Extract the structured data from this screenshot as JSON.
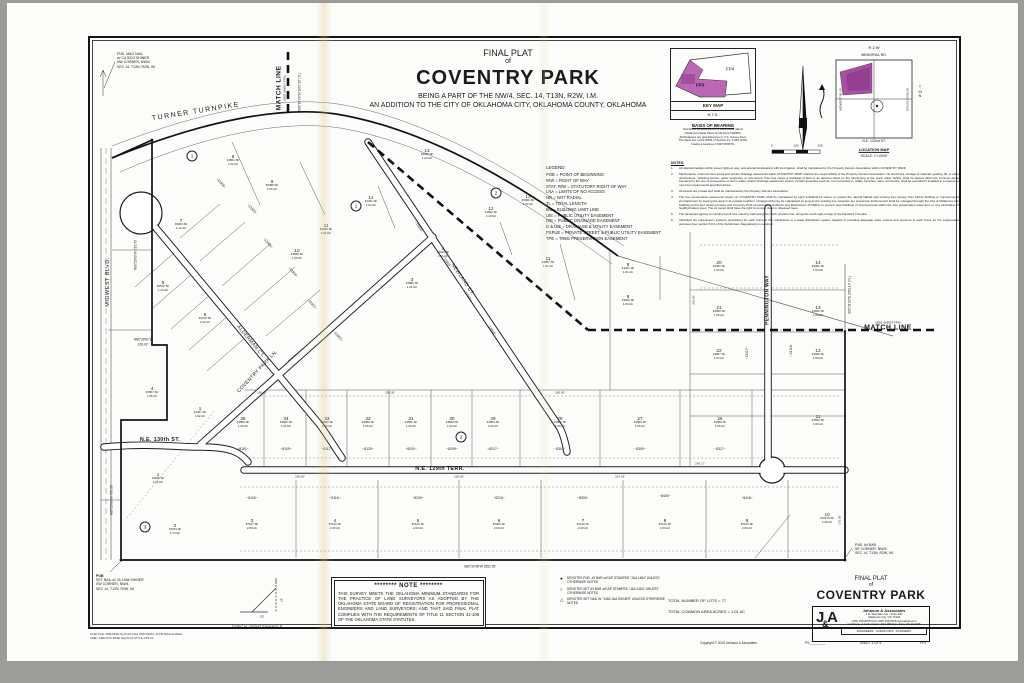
{
  "title_block": {
    "line1": "FINAL PLAT",
    "line2": "of",
    "name": "COVENTRY PARK",
    "line4": "BEING A PART OF THE NW/4, SEC. 14, T13N, R2W, I.M.",
    "line5": "AN ADDITION TO THE CITY OF OKLAHOMA CITY, OKLAHOMA COUNTY, OKLAHOMA"
  },
  "key_map": {
    "fp4": "FP4",
    "fp3": "FP3",
    "title": "KEY MAP",
    "nts": "N.T.S.",
    "basis_title": "BASIS OF BEARING",
    "basis_lines": [
      "Grid North as established by state plane datum",
      "(Oklahoma State Plane North Zone NAD83).",
      "All Distances are grid distances in U.S. Survey Feet.",
      "The West line of the NW/4 of Section 14, T13N, R2W,",
      "having a bearing of N00°20'09\"W."
    ],
    "accent": "#b864b0"
  },
  "location_map": {
    "r2w": "R  2  W",
    "memorial": "MEMORIAL RD.",
    "midwest": "MIDWEST BLVD.",
    "douglas": "DOUGLAS BLVD.",
    "t13n": [
      "T",
      "13",
      "N"
    ],
    "ne122": "N.E. 122nd ST.",
    "title": "LOCATION MAP",
    "scale": "SCALE: 1\"=2000'"
  },
  "scale_bar": {
    "labels": [
      "0",
      "100",
      "200"
    ]
  },
  "legend": {
    "title": "LEGEND:",
    "items": [
      "POB = POINT OF BEGINNING",
      "R/W = RIGHT OF WAY",
      "STAT. R/W = STATUTORY RIGHT OF WAY",
      "LNA = LIMITS OF NO ACCESS",
      "NR = NOT RADIAL",
      "TL = TOTAL LENGTH",
      "B/L = BUILDING LIMIT LINE",
      "U/E = PUBLIC UTILITY EASEMENT",
      "D/E = PUBLIC DRAINAGE EASEMENT",
      "D & U/E = DRAINAGE & UTILITY EASEMENT",
      "PSPUE = PRIVATE STREET & PUBLIC UTILITY EASEMENT",
      "TPE = TREE PRESERVATION EASEMENT"
    ]
  },
  "notes": {
    "title": "NOTES:",
    "items": [
      "All islands/medians within street rights-of-way, and arterial landscaping with its irrigation, shall be maintained by the Property Owners Association within COVENTRY PARK.",
      "Maintenance of all common areas and private drainage easements within COVENTRY PARK shall be the responsibility of the Property Owners Association. No structures, storage of material, grading, fill, or other obstructions, including fences, either temporary or permanent, that may cause a blockage of flow or an adverse effect on the functioning of the storm water facility, shall be placed within the common areas intended for the use of conveyance of storm water, and/or drainage easements shown. Certain amenities such as, but not limited to, walks, benches, piers, and docks, shall be permitted if installed in a manner to meet the requirements specified above.",
      "All streets are private and shall be maintained by the Property Owners Association.",
      "The tree preservation easements shown on COVENTRY PARK shall be maintained by each individual lot owner, to protect the natural habitat and existing tree canopy from further building or improvements encroachment by leaving the area in its natural condition. Undergrowth may be maintained so long as the existing tree canopies are preserved. Enforcement shall be managed through the City of Oklahoma City building permit and review process and Coventry Park Covenants, Conditions and Restrictions (CC&R's) to prevent new buildings or improvements within the tree preservation easement, or any elimination of healthy/mature trees. The lot owner shall have the right to remove dead or diseased trees.",
      "The developer agrees to construct an 8-foot masonry wall along the North property line, along the south right-of-way of the Kilpatrick Turnpike.",
      "Individual fire suppression systems (sprinklers) for each home in this subdivision or a water distribution system capable of providing adequate water volume and pressure to each home for fire suppression purposes (per section 5.8.4 of the Subdivision Regulations) is required."
    ]
  },
  "plat": {
    "street_labels": [
      {
        "t": "TURNER TURNPIKE",
        "x": 196,
        "y": 112,
        "r": -9,
        "s": 7,
        "b": 0,
        "sp": 1.5
      },
      {
        "t": "MIDWEST BLVD.",
        "x": 109,
        "y": 282,
        "r": -90,
        "s": 5.5,
        "b": 0,
        "sp": 0.5
      },
      {
        "t": "ALDERMAN CT.",
        "x": 250,
        "y": 342,
        "r": 50,
        "s": 5,
        "b": 0,
        "sp": 0.3
      },
      {
        "t": "NEWLAND CT.",
        "x": 462,
        "y": 280,
        "r": 56,
        "s": 5,
        "b": 0,
        "sp": 0.3
      },
      {
        "t": "COVENTRY PARK LN.",
        "x": 258,
        "y": 372,
        "r": -47,
        "s": 5,
        "b": 0,
        "sp": 0.3
      },
      {
        "t": "PENNINGTON WAY",
        "x": 768,
        "y": 300,
        "r": -90,
        "s": 5,
        "b": 1,
        "sp": 0.3
      },
      {
        "t": "N.E. 130th ST.",
        "x": 160,
        "y": 441,
        "r": 0,
        "s": 5.5,
        "b": 1,
        "sp": 0.3
      },
      {
        "t": "N.E. 129th TERR.",
        "x": 440,
        "y": 470,
        "r": 0,
        "s": 5.5,
        "b": 1,
        "sp": 0.3
      }
    ],
    "match_top": {
      "big": "MATCH LINE",
      "small": "(SEE SHEET FP4)"
    },
    "match_right": {
      "big": "MATCH LINE",
      "small": "(SEE SHEET FP4)"
    },
    "bearings": [
      {
        "t": "N00°15'29\"W  1957.35' (TL)",
        "x": 300,
        "y": 92,
        "r": -90
      },
      {
        "t": "N00°20'09\"W  713.70'",
        "x": 136,
        "y": 255,
        "r": -90
      },
      {
        "t": "N89°39'51\"E",
        "x": 143,
        "y": 340,
        "r": 0
      },
      {
        "t": "100.00'",
        "x": 143,
        "y": 345,
        "r": 0
      },
      {
        "t": "N00°20'09\"W  735.90'",
        "x": 112,
        "y": 500,
        "r": -90
      },
      {
        "t": "S00°21'03\"E  2031.14' (TL)",
        "x": 850,
        "y": 295,
        "r": -90
      },
      {
        "t": "S89°32'48\"W  2652.05'",
        "x": 480,
        "y": 567,
        "r": 0
      }
    ],
    "corner_notes": [
      {
        "lines": [
          "FND. MAG NAIL",
          "w/ CA 5313 SHINER",
          "NW CORNER, NW/4,",
          "SEC 14, T13N, R2W, IM"
        ],
        "x": 117,
        "y": 52,
        "bold_first": false
      },
      {
        "lines": [
          "POB",
          "SET NAIL w/ JA 1484 SHINER",
          "SW CORNER, NW/4,",
          "SEC 14, T13N, R2W, IM"
        ],
        "x": 96,
        "y": 574,
        "bold_first": true
      },
      {
        "lines": [
          "FND. #4 BAR",
          "SE CORNER, NW/4,",
          "SEC 14, T13N, R2W, IM"
        ],
        "x": 855,
        "y": 543,
        "bold_first": false
      }
    ],
    "lots": [
      {
        "n": "7",
        "a": "49003 SF",
        "c": "1.12 AC",
        "x": 181,
        "y": 224
      },
      {
        "n": "8",
        "a": "44501 SF",
        "c": "1.02 AC",
        "x": 233,
        "y": 160
      },
      {
        "n": "9",
        "a": "45098 SF",
        "c": "1.04 AC",
        "x": 272,
        "y": 185
      },
      {
        "n": "10",
        "a": "44996 SF",
        "c": "1.03 AC",
        "x": 297,
        "y": 254
      },
      {
        "n": "11",
        "a": "44936 SF",
        "c": "1.03 AC",
        "x": 326,
        "y": 229
      },
      {
        "n": "12",
        "a": "44341 SF",
        "c": "1.02 AC",
        "x": 371,
        "y": 201
      },
      {
        "n": "13",
        "a": "54046 SF",
        "c": "1.24 AC",
        "x": 427,
        "y": 154
      },
      {
        "n": "12",
        "a": "44932 SF",
        "c": "1.13 AC",
        "x": 491,
        "y": 212
      },
      {
        "n": "13",
        "a": "45000 SF",
        "c": "1.03 AC",
        "x": 528,
        "y": 200
      },
      {
        "n": "4",
        "a": "44343 SF",
        "c": "1.01 AC",
        "x": 443,
        "y": 252
      },
      {
        "n": "3",
        "a": "43985 SF",
        "c": "1.01 AC",
        "x": 412,
        "y": 283
      },
      {
        "n": "11",
        "a": "43867 SF",
        "c": "1.01 AC",
        "x": 548,
        "y": 262
      },
      {
        "n": "5",
        "a": "49572 SF",
        "c": "1.14 AC",
        "x": 163,
        "y": 286
      },
      {
        "n": "6",
        "a": "45210 SF",
        "c": "1.04 AC",
        "x": 205,
        "y": 318
      },
      {
        "n": "4",
        "a": "45807 SF",
        "c": "1.05 AC",
        "x": 152,
        "y": 392
      },
      {
        "n": "1",
        "a": "44407 SF",
        "c": "1.02 AC",
        "x": 200,
        "y": 412
      },
      {
        "n": "1",
        "a": "43946 SF",
        "c": "1.00 AC",
        "x": 158,
        "y": 478
      },
      {
        "n": "2",
        "a": "75234 SF",
        "c": "1.73 AC",
        "x": 175,
        "y": 529
      },
      {
        "n": "8",
        "a": "44201 SF",
        "c": "1.01 AC",
        "x": 628,
        "y": 268
      },
      {
        "n": "9",
        "a": "43560 SF",
        "c": "1.00 AC",
        "x": 628,
        "y": 300
      },
      {
        "n": "35",
        "a": "43560 SF",
        "c": "1.00 AC",
        "x": 243,
        "y": 422
      },
      {
        "n": "34",
        "a": "43560 SF",
        "c": "1.00 AC",
        "x": 286,
        "y": 422
      },
      {
        "n": "33",
        "a": "43560 SF",
        "c": "1.00 AC",
        "x": 327,
        "y": 422
      },
      {
        "n": "32",
        "a": "43560 SF",
        "c": "1.00 AC",
        "x": 368,
        "y": 422
      },
      {
        "n": "31",
        "a": "43560 SF",
        "c": "1.00 AC",
        "x": 411,
        "y": 422
      },
      {
        "n": "30",
        "a": "43560 SF",
        "c": "1.00 AC",
        "x": 452,
        "y": 422
      },
      {
        "n": "29",
        "a": "43560 SF",
        "c": "1.00 AC",
        "x": 493,
        "y": 422
      },
      {
        "n": "28",
        "a": "43560 SF",
        "c": "1.00 AC",
        "x": 560,
        "y": 422
      },
      {
        "n": "27",
        "a": "43560 SF",
        "c": "1.00 AC",
        "x": 640,
        "y": 422
      },
      {
        "n": "26",
        "a": "43560 SF",
        "c": "1.00 AC",
        "x": 720,
        "y": 422
      },
      {
        "n": "20",
        "a": "45000 SF",
        "c": "1.03 AC",
        "x": 719,
        "y": 266
      },
      {
        "n": "21",
        "a": "43560 SF",
        "c": "1.00 AC",
        "x": 719,
        "y": 311
      },
      {
        "n": "22",
        "a": "44867 SF",
        "c": "1.03 AC",
        "x": 719,
        "y": 354
      },
      {
        "n": "14",
        "a": "45000 SF",
        "c": "1.03 AC",
        "x": 818,
        "y": 266
      },
      {
        "n": "13",
        "a": "43560 SF",
        "c": "1.00 AC",
        "x": 818,
        "y": 311
      },
      {
        "n": "12",
        "a": "43560 SF",
        "c": "1.00 AC",
        "x": 818,
        "y": 354
      },
      {
        "n": "11",
        "a": "43560 SF",
        "c": "1.00 AC",
        "x": 818,
        "y": 420
      },
      {
        "n": "3",
        "a": "87017 SF",
        "c": "2.00 AC",
        "x": 252,
        "y": 524
      },
      {
        "n": "4",
        "a": "87120 SF",
        "c": "2.00 AC",
        "x": 335,
        "y": 524
      },
      {
        "n": "5",
        "a": "87120 SF",
        "c": "2.00 AC",
        "x": 418,
        "y": 524
      },
      {
        "n": "6",
        "a": "87000 SF",
        "c": "2.00 AC",
        "x": 499,
        "y": 524
      },
      {
        "n": "7",
        "a": "87120 SF",
        "c": "2.00 AC",
        "x": 583,
        "y": 524
      },
      {
        "n": "8",
        "a": "87120 SF",
        "c": "2.00 AC",
        "x": 665,
        "y": 524
      },
      {
        "n": "9",
        "a": "87120 SF",
        "c": "2.00 AC",
        "x": 747,
        "y": 524
      },
      {
        "n": "10",
        "a": "100479 SF",
        "c": "2.39 AC",
        "x": 827,
        "y": 518
      }
    ],
    "addresses": [
      {
        "t": "~8101~",
        "x": 243,
        "y": 449,
        "r": 0
      },
      {
        "t": "~8109~",
        "x": 286,
        "y": 449,
        "r": 0
      },
      {
        "t": "~8117~",
        "x": 327,
        "y": 449,
        "r": 0
      },
      {
        "t": "~8125~",
        "x": 368,
        "y": 449,
        "r": 0
      },
      {
        "t": "~8200~",
        "x": 411,
        "y": 449,
        "r": 0
      },
      {
        "t": "~8209~",
        "x": 452,
        "y": 449,
        "r": 0
      },
      {
        "t": "~8217~",
        "x": 493,
        "y": 449,
        "r": 0
      },
      {
        "t": "~8301~",
        "x": 560,
        "y": 449,
        "r": 0
      },
      {
        "t": "~8309~",
        "x": 640,
        "y": 449,
        "r": 0
      },
      {
        "t": "~8317~",
        "x": 720,
        "y": 449,
        "r": 0
      },
      {
        "t": "~8100~",
        "x": 252,
        "y": 498,
        "r": 0
      },
      {
        "t": "~8116~",
        "x": 335,
        "y": 498,
        "r": 0
      },
      {
        "t": "~8200~",
        "x": 418,
        "y": 498,
        "r": 0
      },
      {
        "t": "~8216~",
        "x": 499,
        "y": 498,
        "r": 0
      },
      {
        "t": "~8300~",
        "x": 583,
        "y": 498,
        "r": 0
      },
      {
        "t": "~8400~",
        "x": 665,
        "y": 496,
        "r": 0
      },
      {
        "t": "~8416~",
        "x": 747,
        "y": 498,
        "r": 0
      },
      {
        "t": "~13117~",
        "x": 747,
        "y": 353,
        "r": -90
      },
      {
        "t": "~13116~",
        "x": 791,
        "y": 350,
        "r": -90
      },
      {
        "t": "~13308~",
        "x": 221,
        "y": 183,
        "r": 49
      },
      {
        "t": "~13309~",
        "x": 252,
        "y": 209,
        "r": 49
      },
      {
        "t": "~13305~",
        "x": 268,
        "y": 243,
        "r": 49
      },
      {
        "t": "~13304~",
        "x": 293,
        "y": 272,
        "r": 49
      },
      {
        "t": "~13301~",
        "x": 312,
        "y": 304,
        "r": 49
      },
      {
        "t": "~13300~",
        "x": 338,
        "y": 336,
        "r": 49
      },
      {
        "t": "~13324~",
        "x": 419,
        "y": 227,
        "r": 56
      },
      {
        "t": "~13320~",
        "x": 447,
        "y": 262,
        "r": 56
      },
      {
        "t": "~13321~",
        "x": 468,
        "y": 296,
        "r": 56
      },
      {
        "t": "~13316~",
        "x": 492,
        "y": 330,
        "r": 56
      }
    ],
    "blocks": [
      {
        "n": "1",
        "x": 192,
        "y": 156
      },
      {
        "n": "1",
        "x": 356,
        "y": 206
      },
      {
        "n": "2",
        "x": 496,
        "y": 193
      },
      {
        "n": "2",
        "x": 461,
        "y": 437
      },
      {
        "n": "3",
        "x": 145,
        "y": 527
      }
    ],
    "dims": [
      {
        "t": "150.00'",
        "x": 262,
        "y": 393,
        "r": 0
      },
      {
        "t": "150.00'",
        "x": 390,
        "y": 393,
        "r": 0
      },
      {
        "t": "165.00'",
        "x": 560,
        "y": 393,
        "r": 0
      },
      {
        "t": "290.17'",
        "x": 700,
        "y": 464,
        "r": 0
      },
      {
        "t": "160.00'",
        "x": 300,
        "y": 477,
        "r": 0
      },
      {
        "t": "160.00'",
        "x": 459,
        "y": 477,
        "r": 0
      },
      {
        "t": "142.35'",
        "x": 620,
        "y": 477,
        "r": 0
      },
      {
        "t": "363.00'",
        "x": 694,
        "y": 300,
        "r": -90
      },
      {
        "t": "175.00'",
        "x": 840,
        "y": 520,
        "r": -90
      }
    ]
  },
  "bottom": {
    "sight_triangle": {
      "caption": "TYPICAL SIGHT TRIANGLE",
      "dim_h": "25'",
      "dim_v": "25'"
    },
    "note_box": {
      "title": "******** NOTE ********",
      "body": "THIS SURVEY MEETS THE OKLAHOMA MINIMUM STANDARDS FOR THE PRACTICE OF LAND SURVEYORS AS ADOPTED BY THE OKLAHOMA STATE BOARD OF REGISTRATION FOR PROFESSIONAL ENGINEERS AND LAND SURVEYORS; AND THAT SAID FINAL PLAT COMPLIES WITH THE REQUIREMENTS OF TITLE 11 SECTION 41-108 OF THE OKLAHOMA STATE STATUTES."
    },
    "symbols": [
      {
        "sym": "●",
        "text": "DENOTES FND. #3 BAR w/CAP STAMPED \"J&A 1484\" UNLESS OTHERWISE NOTED"
      },
      {
        "sym": "○",
        "text": "DENOTES SET #3 BAR w/CAP STAMPED \"J&A 1484\" UNLESS OTHERWISE NOTED"
      },
      {
        "sym": "△",
        "text": "DENOTES SET NAIL IN \"1484 J&A SHINER\" UNLESS OTHERWISE NOTED"
      }
    ],
    "totals": [
      "TOTAL NUMBER OF LOTS = 77",
      "TOTAL COMMON AREA ACRES = 1.01 AC"
    ],
    "final_plat": {
      "l1": "FINAL PLAT",
      "l2": "of",
      "name": "COVENTRY PARK"
    },
    "firm": {
      "logo_j": "J",
      "logo_amp": "&",
      "logo_a": "A",
      "name": "Johnson & Associates",
      "addr1": "1 E. Sheridan Ave., Suite 200",
      "addr2": "Oklahoma City, OK 73104",
      "phone": "(405) 235-8075    FAX (405) 235-8078    www.jaokc.com",
      "cert": "Certificate of Authorization #CA 983    Exp. Date: 06-30-2025",
      "services": "·  ENGINEERS  ·  SURVEYORS  ·  PLANNERS  ·"
    },
    "strip": {
      "copyright": "Copyright © 2025 Johnson & Associates",
      "pv": "PV:____.____",
      "sheet": "SHEET 3 OF 4",
      "code": "FP3"
    },
    "file_info": [
      "ACAD FILE: 4488 FINAL PLAT-FP3.dwg  03/07/2025  1:42 PM  Rebecca Baker",
      "XREF: 4488-CIVIL BASE.dwg   PLOT STYLE: FP3.ctb"
    ]
  }
}
